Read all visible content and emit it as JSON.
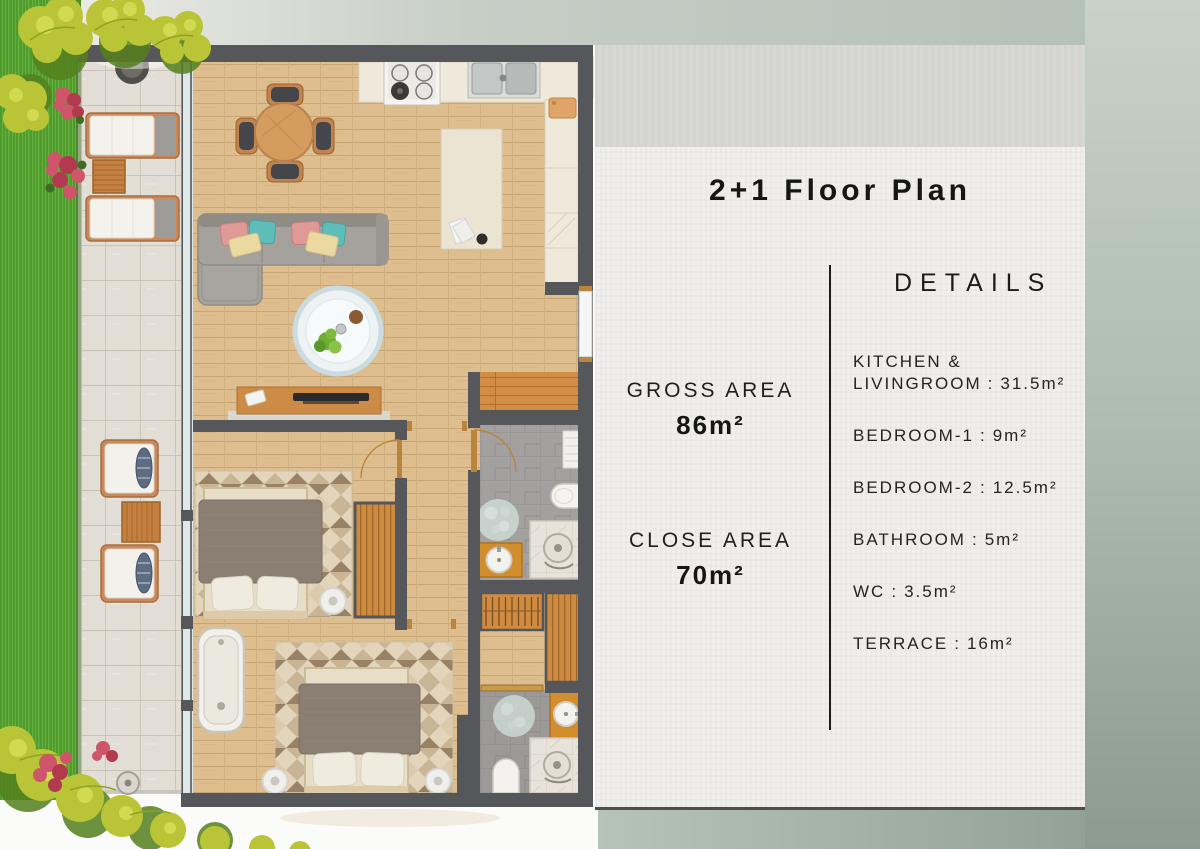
{
  "panel": {
    "title": "2+1 Floor Plan",
    "details_heading": "DETAILS",
    "separator": ":",
    "areas": [
      {
        "label": "GROSS AREA",
        "value": "86m²"
      },
      {
        "label": "CLOSE AREA",
        "value": "70m²"
      }
    ],
    "rooms": [
      {
        "label": "KITCHEN &\nLIVINGROOM",
        "value": "31.5m²"
      },
      {
        "label": "BEDROOM-1",
        "value": "9m²"
      },
      {
        "label": "BEDROOM-2",
        "value": "12.5m²"
      },
      {
        "label": "BATHROOM",
        "value": "5m²"
      },
      {
        "label": "WC",
        "value": "3.5m²"
      },
      {
        "label": "TERRACE",
        "value": "16m²"
      }
    ]
  },
  "floorplan": {
    "colors": {
      "wall": "#55575a",
      "wood_floor": "#ddbc8c",
      "entry_wood": "#d08d43",
      "terrace_tile": "#e2ddd5",
      "grass": "#56a434",
      "bath_tile": "#a2a19f",
      "cabinet_orange": "#cf8b42",
      "sofa_gray": "#a5a29d",
      "bed_blanket": "#8b7f74",
      "accent_teal": "#5fbdb9",
      "accent_pink": "#e09a95",
      "flower_red": "#cf5568",
      "plant_yellow_green": "#b9c437",
      "panel_bg": "#f0efed",
      "panel_band": "#d7d7d5",
      "text": "#1d1d1b"
    }
  }
}
